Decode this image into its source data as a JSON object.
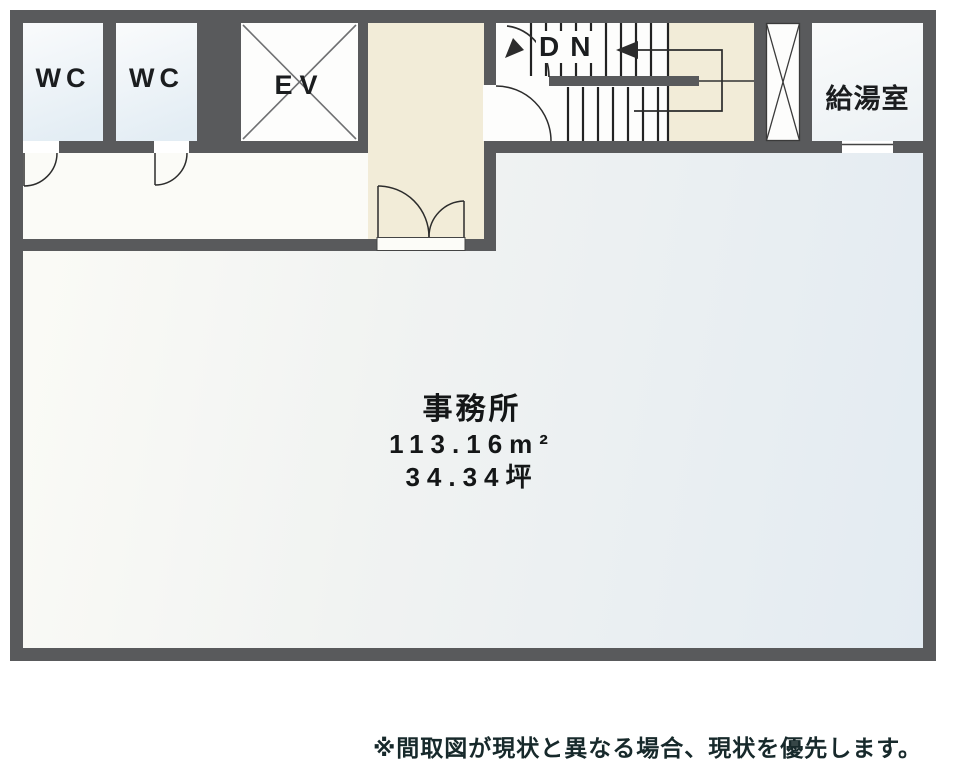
{
  "rooms": {
    "wc1": {
      "label": "WC"
    },
    "wc2": {
      "label": "WC"
    },
    "elevator": {
      "label": "EV"
    },
    "stairs": {
      "label": "DN"
    },
    "kitchenette": {
      "label": "給湯室"
    },
    "office": {
      "name": "事務所",
      "area_sqm": "113.16m²",
      "area_tsubo": "34.34坪"
    }
  },
  "disclaimer": "※間取図が現状と異なる場合、現状を優先します。",
  "colors": {
    "wall": "#595a5c",
    "hallway_cream": "#f2ecd8",
    "office_tint_blue": "#e3ebf2",
    "wc_tint_blue": "#e3edf4",
    "linework": "#2c2c2c"
  }
}
